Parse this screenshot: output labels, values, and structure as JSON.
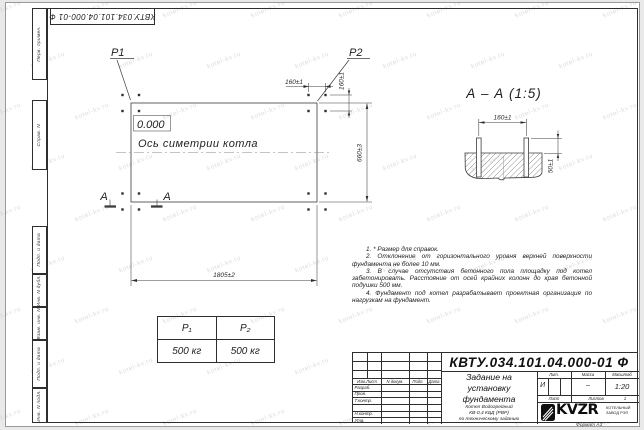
{
  "page": {
    "watermark_text": "kotel-kv.ru",
    "format_label": "Формат А3"
  },
  "stamp_vertical": {
    "doc_number_top": "КВТУ.034.101.04.000-01  Ф",
    "margins": {
      "perv": "Перв. примен.",
      "sprav": "Справ. N",
      "pd1": "Подп. и дата",
      "dubl": "Инв. N дубл.",
      "vzam": "Взам. инв. N",
      "pd2": "Подп. и дата",
      "podl": "Инв. N подл."
    }
  },
  "plan": {
    "p1": "P1",
    "p2": "P2",
    "elevation": "0.000",
    "axis_label": "Ось симетрии котла",
    "section_letter": "А",
    "dims": {
      "bolt_h": "160±1",
      "bolt_v": "160±1",
      "width": "1805±2",
      "depth": "660±3"
    }
  },
  "section": {
    "title": "А – А (1:5)",
    "dims": {
      "bolts": "160±1",
      "height": "50±1"
    }
  },
  "loads": {
    "headers": [
      "P₁",
      "P₂"
    ],
    "values": [
      "500 кг",
      "500 кг"
    ]
  },
  "notes": [
    "1. * Размер для справок.",
    "2. Отклонение от горизонтального уровня верхней поверхности фундамента не более 10 мм.",
    "3. В случае отсутствия бетонного пола площадку под котел забетонировать. Расстояние от осей крайних колонн до края бетонной подушки 500 мм.",
    "4. Фундамент под котел разрабатывает проектная организация по нагрузкам на фундамент."
  ],
  "title_block": {
    "doc_number": "КВТУ.034.101.04.000-01  Ф",
    "title_l1": "Задание на",
    "title_l2": "установку",
    "title_l3": "фундамента",
    "sub_l1": "Котел Водогрейный",
    "sub_l2": "КВ-0,4  КБД  (РВР)",
    "sub_l3": "по техническому заданию",
    "col_izm": "Изм.Лист",
    "col_doc": "N докум.",
    "col_podp": "Подп.",
    "col_data": "Дата",
    "row_razrab": "Разраб.",
    "row_prov": "Пров.",
    "row_tkontr": "Т.контр.",
    "row_nkontr": "Н.контр.",
    "row_utv": "Утв.",
    "lit_header": "Лит.",
    "mass_header": "Масса",
    "scale_header": "Масштаб",
    "lit_value": "И",
    "mass_value": "–",
    "scale_value": "1:20",
    "sheet_label": "Лист",
    "sheets_label": "Листов",
    "sheets_value": "1",
    "logo": "KVZR",
    "logo_sub1": "КОТЕЛЬНЫЙ",
    "logo_sub2": "ЗАВОД РЭП"
  }
}
